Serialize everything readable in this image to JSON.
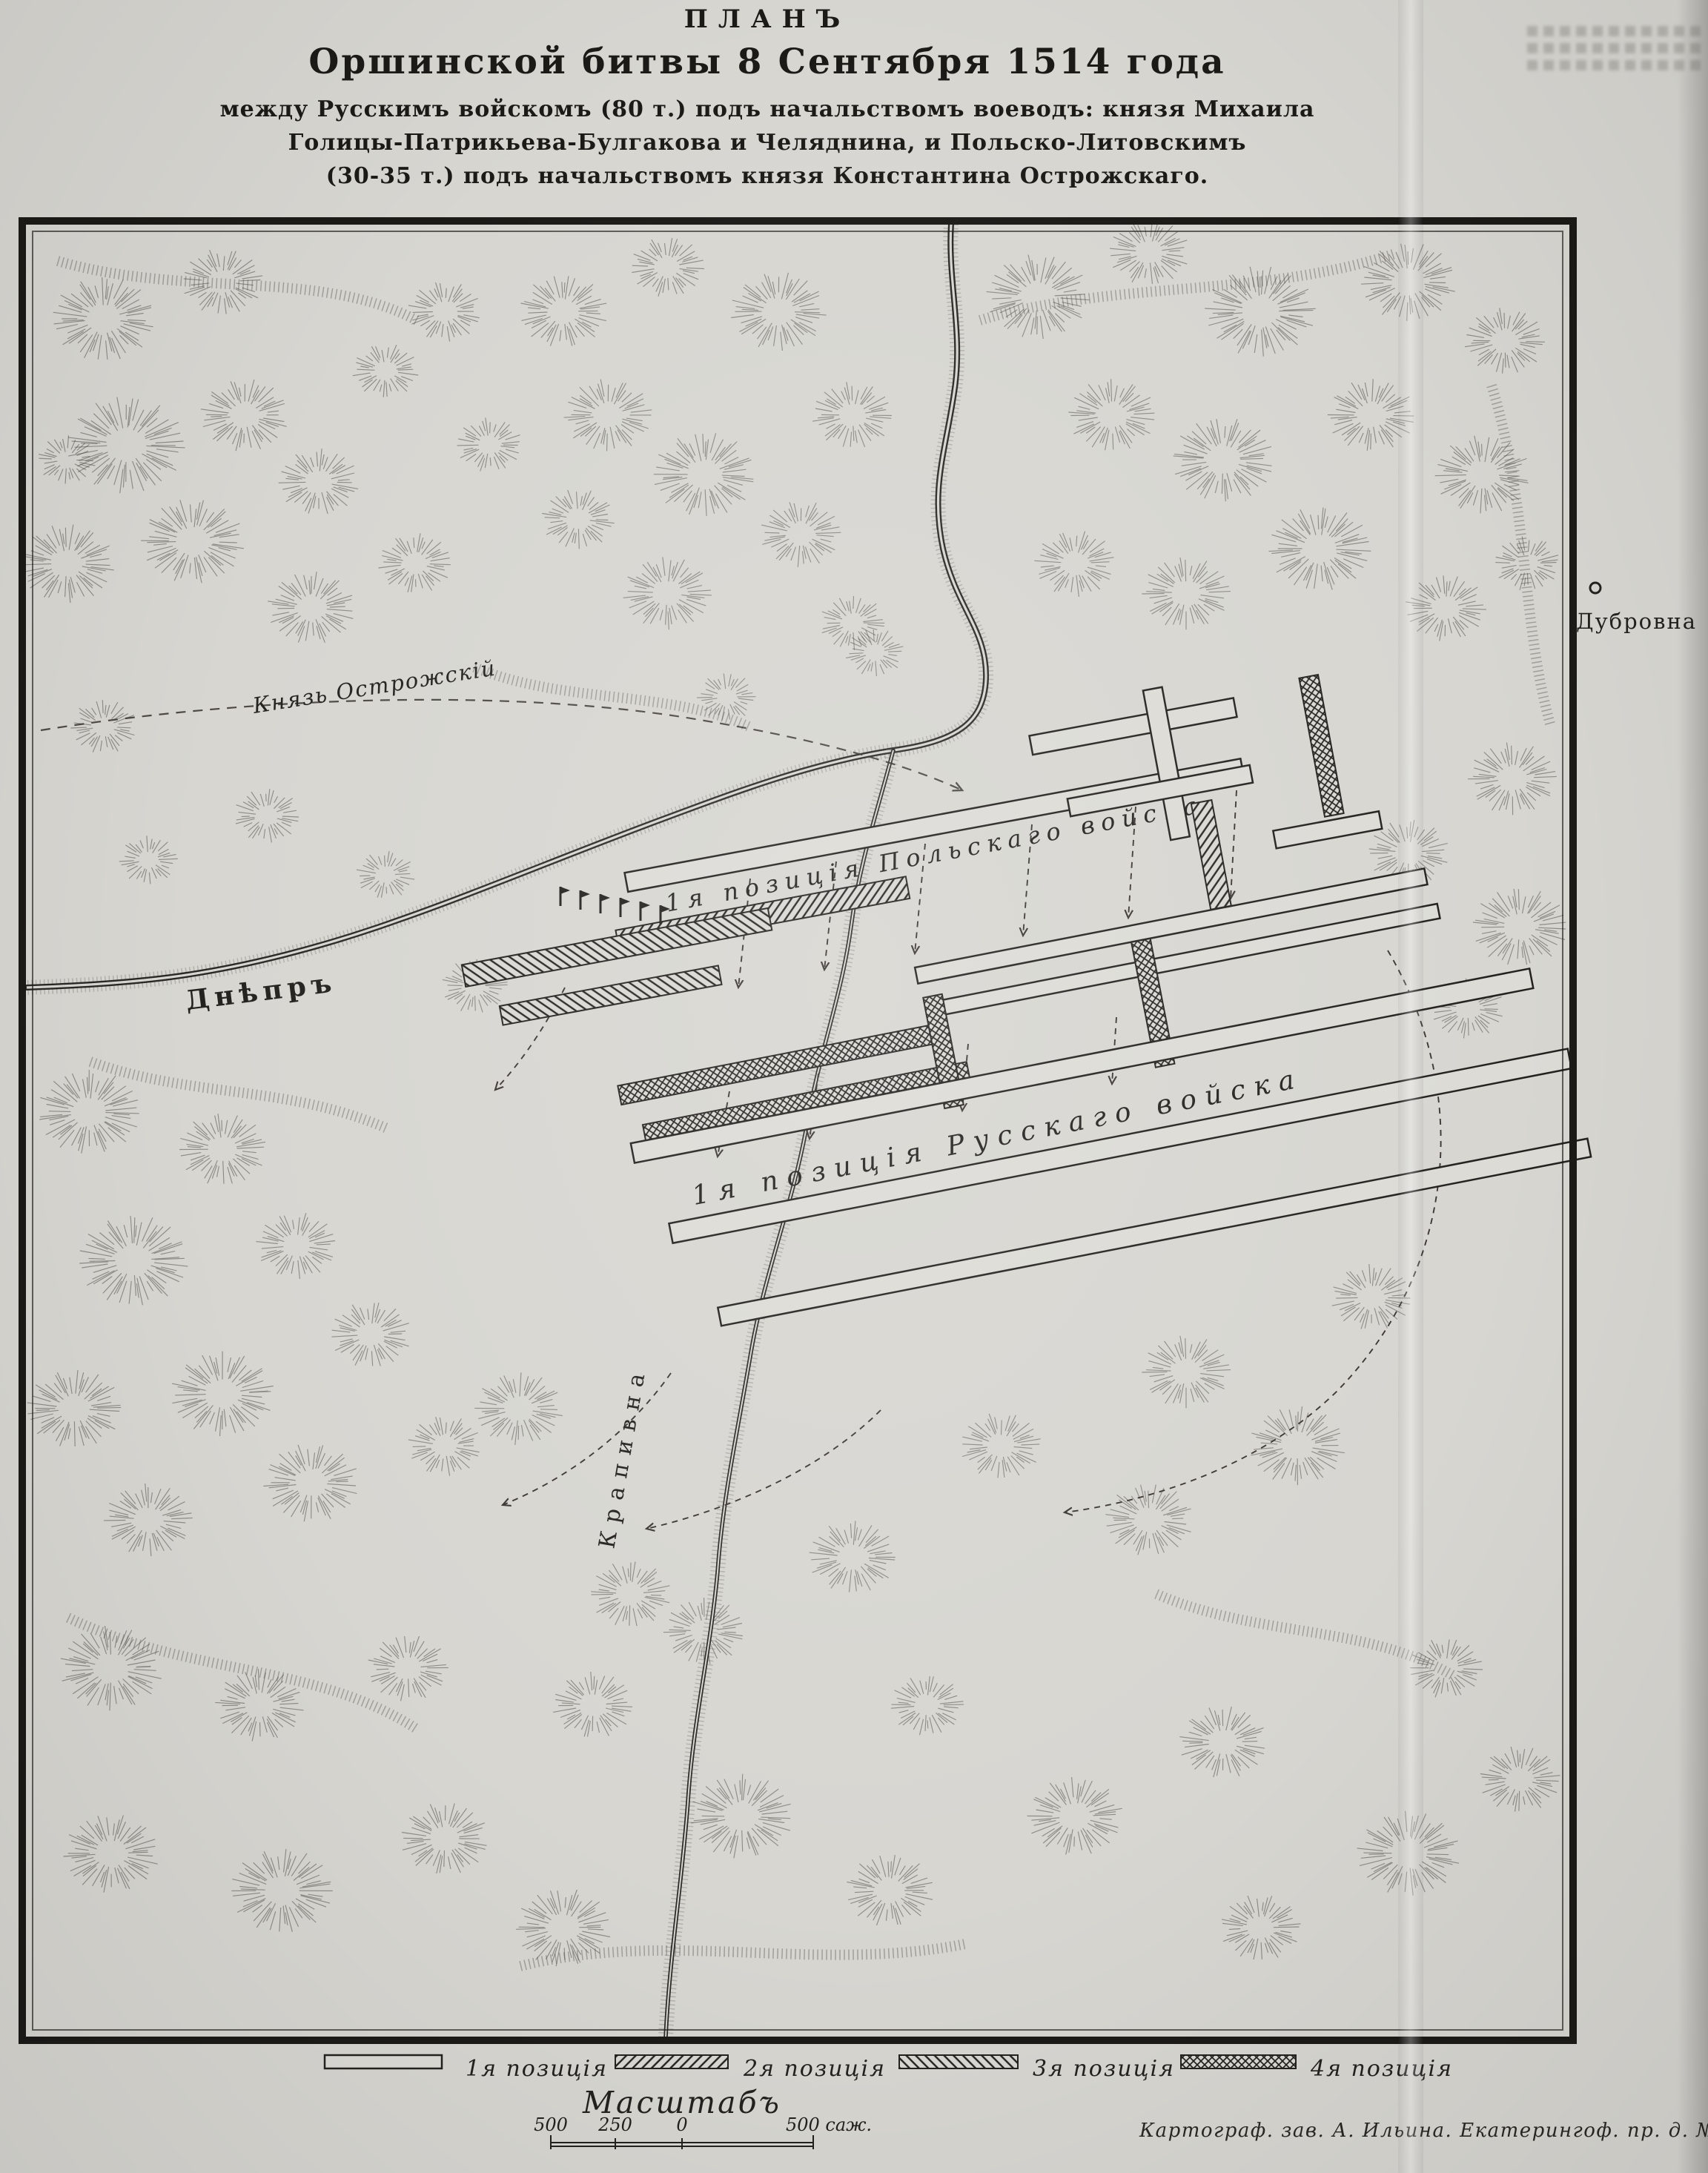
{
  "title": {
    "line1": "ПЛАНЪ",
    "line2": "Оршинской битвы 8 Сентября 1514 года",
    "line3": "между Русскимъ войскомъ (80 т.) подъ начальствомъ воеводъ: князя Михаила",
    "line4": "Голицы-Патрикьева-Булгакова и Челяднина, и Польско-Литовскимъ",
    "line5": "(30-35 т.) подъ начальствомъ князя Константина Острожскаго."
  },
  "map": {
    "labels": {
      "town": "Дубровна",
      "commander_route": "Князь Острожскій",
      "river_dnieper": "Днѣпръ",
      "river_krapivna": "Крапивна",
      "polish_position": "1я позиція Польскаго войска",
      "russian_position": "1я позиція Русскаго войска"
    }
  },
  "legend": {
    "items": [
      {
        "label": "1я позиція",
        "pattern": "outline"
      },
      {
        "label": "2я позиція",
        "pattern": "hatch-forward"
      },
      {
        "label": "3я позиція",
        "pattern": "hatch-back"
      },
      {
        "label": "4я позиція",
        "pattern": "crosshatch"
      }
    ]
  },
  "scale": {
    "title": "Масштабъ",
    "ticks": [
      "500",
      "250",
      "0"
    ],
    "unit_label": "500 саж."
  },
  "credit": "Картограф. зав. А. Ильина. Екатерингоф. пр. д. № 77/43",
  "colors": {
    "paper": "#d7d6d1",
    "ink": "#1c1a17"
  }
}
